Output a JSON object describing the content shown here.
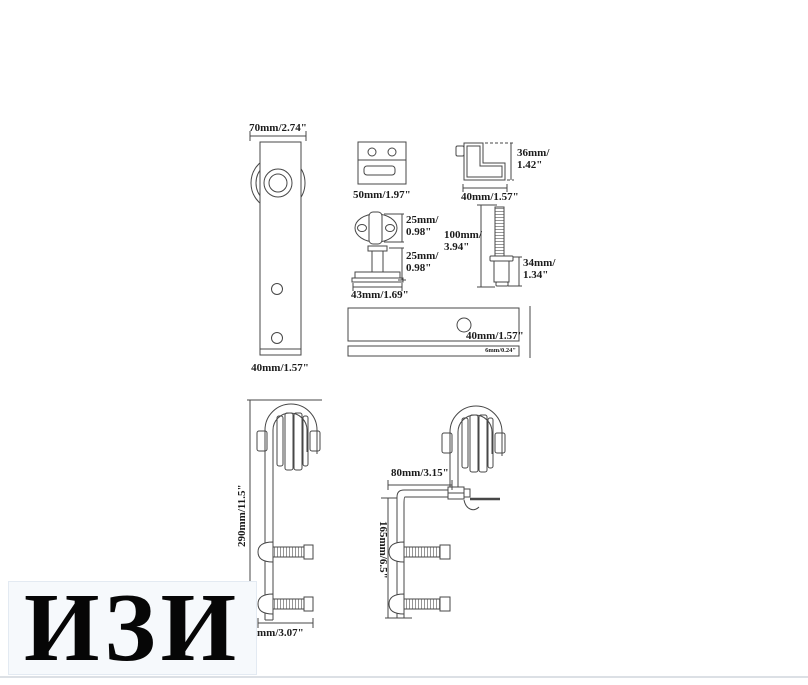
{
  "watermark": {
    "text": "ИЗИ"
  },
  "colors": {
    "line": "#474747",
    "label": "#1c1c1c",
    "page_bg": "#ffffff",
    "watermark_bg": "#f6f9fc",
    "watermark_border": "#e3eaf2",
    "bottom_edge": "#dce0e5"
  },
  "parts": {
    "hanger_front_view": {
      "wheel_width": "70mm/2.74\"",
      "strap_width": "40mm/1.57\""
    },
    "mounting_bracket": {
      "width": "50mm/1.97\""
    },
    "l_bracket": {
      "height_line1": "36mm/",
      "height_line2": "1.42\"",
      "width": "40mm/1.57\""
    },
    "door_stop_top_view": {
      "width_line1": "25mm/",
      "width_line2": "0.98\""
    },
    "door_stop_side_view": {
      "height_line1": "25mm/",
      "height_line2": "0.98\"",
      "base_width": "43mm/1.69\""
    },
    "hanger_bolt": {
      "length_line1": "100mm/",
      "length_line2": "3.94\""
    },
    "spacer": {
      "height_line1": "34mm/",
      "height_line2": "1.34\""
    },
    "rail": {
      "hole_spacing": "40mm/1.57\"",
      "thickness": "6mm/0.24\""
    },
    "assembly_straight": {
      "height": "290mm/11.5\"",
      "width": "78mm/3.07\""
    },
    "assembly_offset": {
      "offset": "80mm/3.15\"",
      "height": "165mm/6.5\""
    }
  }
}
